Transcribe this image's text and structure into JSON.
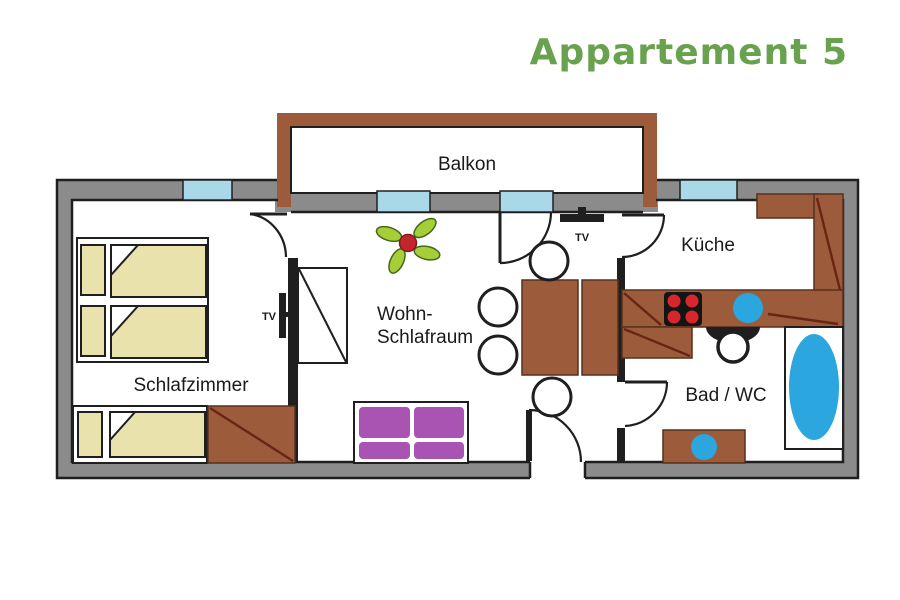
{
  "title": {
    "text": "Appartement 5"
  },
  "rooms": {
    "balcony": "Balkon",
    "kitchen": "Küche",
    "living_line1": "Wohn-",
    "living_line2": "Schlafraum",
    "bedroom": "Schlafzimmer",
    "bathroom": "Bad / WC"
  },
  "labels": {
    "tv_living": "TV",
    "tv_bedroom": "TV"
  },
  "icons": {
    "plant": "plant-icon",
    "tv": "tv-icon",
    "stove": "stove-icon",
    "sink": "sink-icon",
    "toilet": "toilet-icon",
    "bathtub": "bathtub-icon",
    "bed": "bed-icon",
    "sofa": "sofa-icon",
    "wardrobe": "wardrobe-icon",
    "door": "door-swing-icon",
    "window": "window-icon"
  },
  "colors": {
    "wall": "#8b8b8b",
    "line": "#1f1f1f",
    "window": "#a9d9e9",
    "wood": "#9c5c3c",
    "wood_edge": "#57301a",
    "wood_diag": "#6b2414",
    "bed": "#eae2ad",
    "sofa": "#a953b2",
    "fixture": "#2ba6df",
    "burner": "#d7262c",
    "stove": "#141414",
    "leaf": "#a6ce39",
    "leaf_edge": "#44691d",
    "berry": "#c4262e",
    "title": "#68a24f",
    "text": "#1a1a1a"
  }
}
